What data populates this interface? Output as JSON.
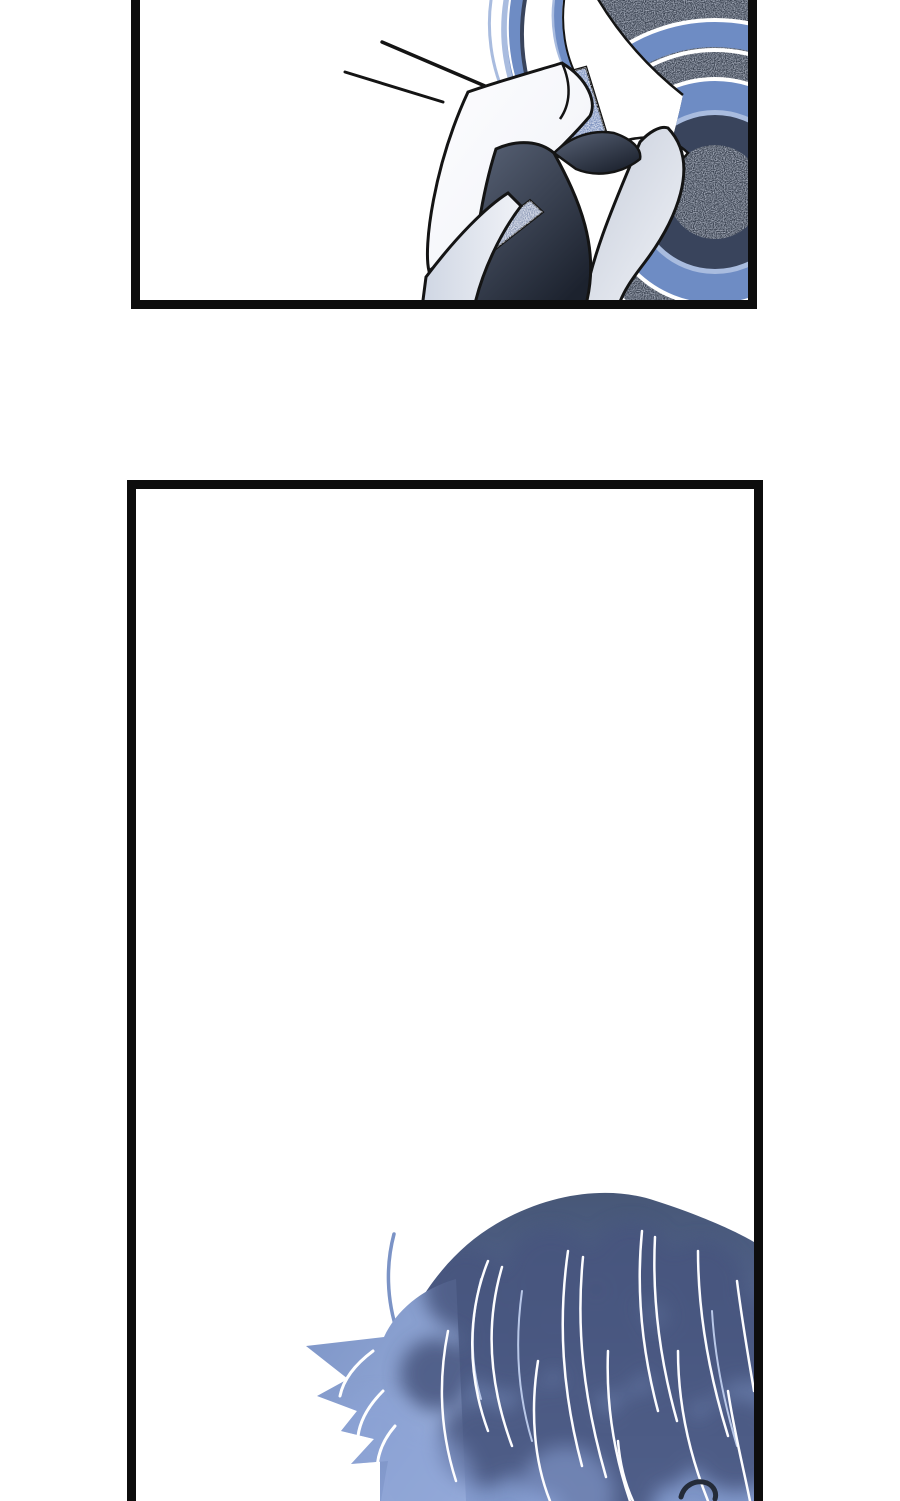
{
  "colors": {
    "page_bg": "#ffffff",
    "panel_border": "#0d0d0d",
    "ink": "#141414",
    "hair_light": "#a9bcdf",
    "hair_mid": "#6e8cc4",
    "hair_navy": "#39445c",
    "speckle_base": "#343c4a",
    "speckle_blue": "#7087b8",
    "collar_white": "#fdfdff",
    "collar_gray": "#c6cdda",
    "collar_gray_light": "#f0f2f7",
    "lapel_light": "#cfd6e3",
    "strip_blue": "#8794b2",
    "tie_light": "#5a6478",
    "tie_dark": "#1c222e",
    "dome_top": "#475777",
    "dome_mid": "#556690",
    "dome_bottom": "#8097c9",
    "spike_blue": "#7b93c6",
    "spike_light": "#9db1dc",
    "blob_dark": "#46557e",
    "glow_light": "#8ba2d6",
    "strand_white": "#fdfdff",
    "strand_soft": "#b9c8e8",
    "curl_dark": "#242b38"
  },
  "panels": [
    {
      "name": "top-panel",
      "art": "collar-and-tie-closeup-with-emphasis-lines"
    },
    {
      "name": "bottom-panel",
      "art": "blue-haired-head-entering-from-bottom"
    }
  ]
}
